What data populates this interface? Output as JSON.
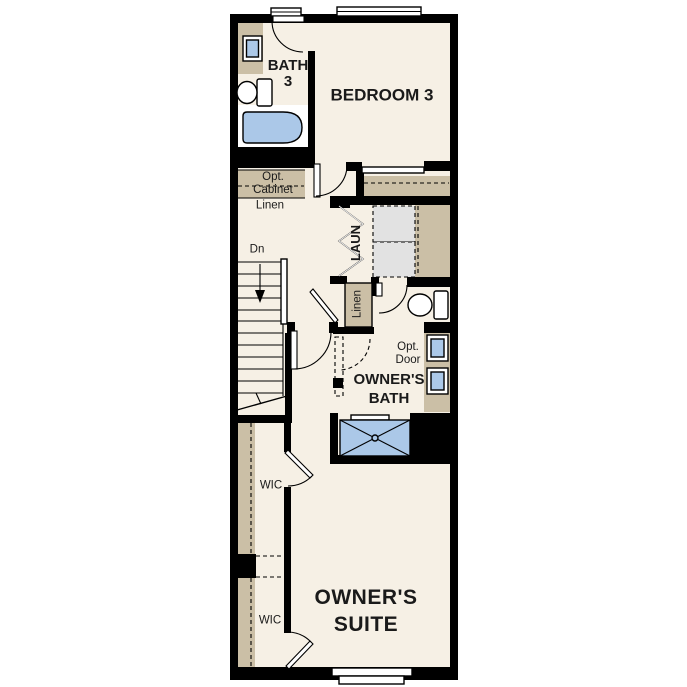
{
  "floorplan": {
    "rooms": {
      "bath3": {
        "label_line1": "BATH",
        "label_line2": "3"
      },
      "bedroom3": {
        "label": "BEDROOM 3"
      },
      "laundry": {
        "label": "LAUN"
      },
      "owners_bath": {
        "label_line1": "OWNER'S",
        "label_line2": "BATH"
      },
      "owners_suite": {
        "label_line1": "OWNER'S",
        "label_line2": "SUITE"
      },
      "wic_upper": {
        "label": "WIC"
      },
      "wic_lower": {
        "label": "WIC"
      }
    },
    "annotations": {
      "opt_cabinet_line1": "Opt.",
      "opt_cabinet_line2": "Cabinet",
      "linen_hall": "Linen",
      "linen_closet": "Linen",
      "stairs_down": "Dn",
      "opt_door_line1": "Opt.",
      "opt_door_line2": "Door"
    },
    "colors": {
      "wall": "#000000",
      "floor": "#F6F0E5",
      "cabinet_tan": "#CBBFA6",
      "fixture_blue": "#ABC8E8",
      "appliance_gray": "#E2E2E2",
      "background": "#FFFFFF"
    }
  }
}
